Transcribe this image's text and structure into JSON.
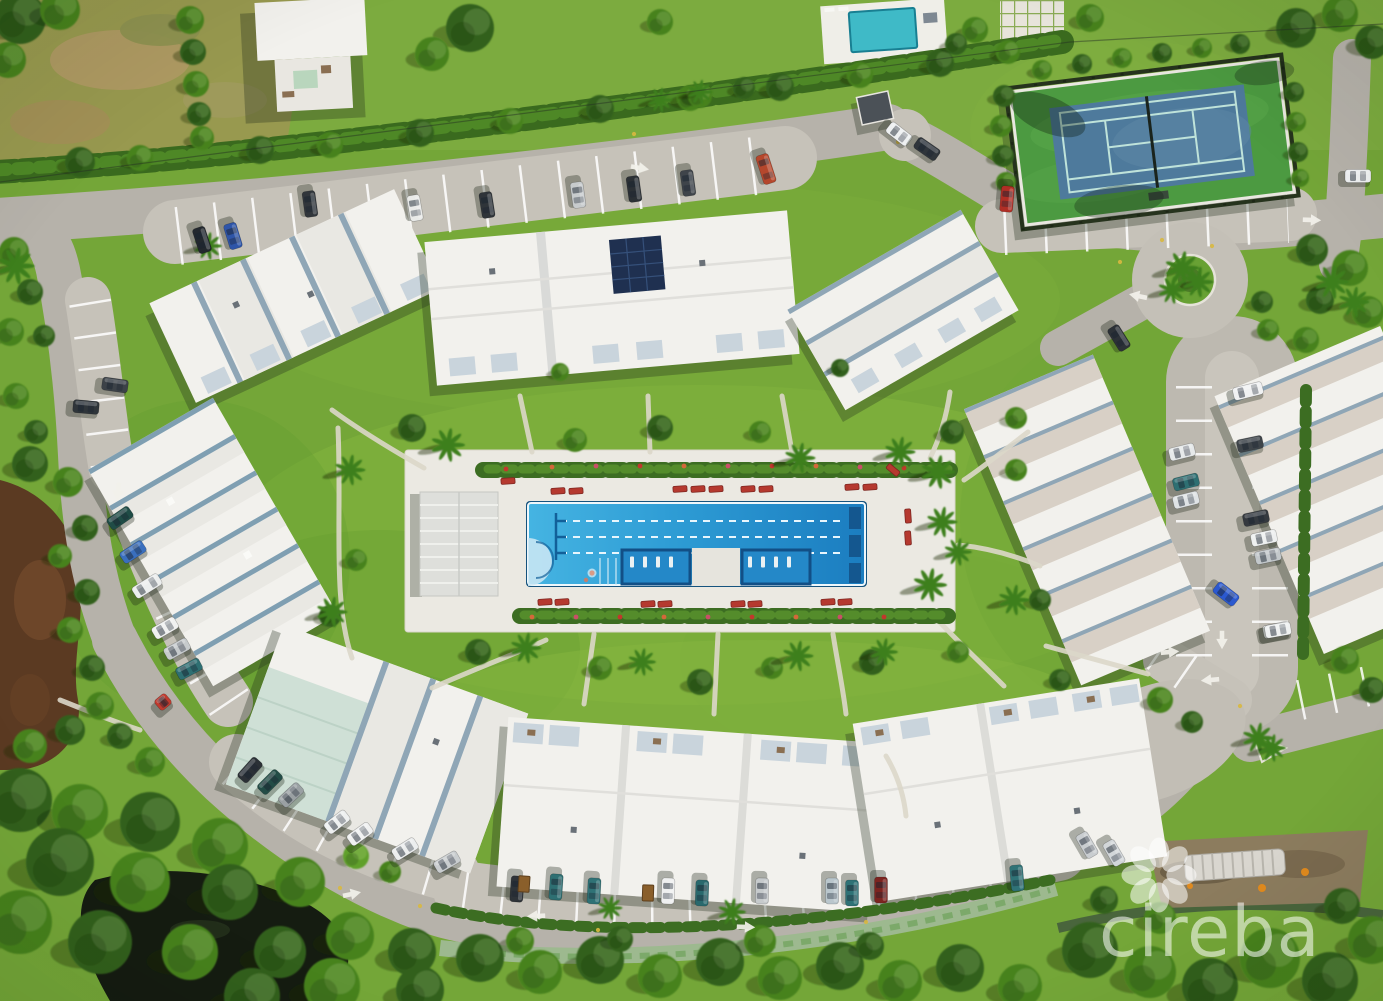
{
  "scene": {
    "description": "Aerial drone photo of a condominium community with central lap pool, tennis court, white-roof buildings, loop road, ponds and mangrove forest",
    "width": 1383,
    "height": 1001
  },
  "watermark": {
    "text": "cireba",
    "logo": "flower-petals-icon",
    "color": "rgba(255,255,255,0.55)"
  },
  "colors": {
    "grass": "#74a638",
    "road": "#b6b2aa",
    "road_light": "#c6c2b9",
    "pool_deck": "#ebe9e2",
    "pool_blue_light": "#3fb2e2",
    "pool_blue_deep": "#1b7dc0",
    "tennis_green": "#4c9a41",
    "tennis_blue": "#4e7a9c",
    "pond_brown": "#5b3a22",
    "pond_dark": "#151c11",
    "roof_white": "#f2f1ed",
    "solar_panel": "#1f3050"
  },
  "pool": {
    "lane_lines": 3,
    "shelves": 2,
    "pool_house": true
  },
  "scene_items": {
    "trees": [
      [
        20,
        18,
        26,
        "d"
      ],
      [
        60,
        10,
        20,
        "m"
      ],
      [
        8,
        60,
        18,
        "m"
      ],
      [
        190,
        20,
        14,
        "m"
      ],
      [
        193,
        52,
        13,
        "d"
      ],
      [
        196,
        84,
        13,
        "m"
      ],
      [
        199,
        114,
        12,
        "d"
      ],
      [
        202,
        138,
        12,
        "m"
      ],
      [
        80,
        162,
        15,
        "d"
      ],
      [
        140,
        158,
        13,
        "m"
      ],
      [
        260,
        150,
        14,
        "d"
      ],
      [
        330,
        145,
        13,
        "m"
      ],
      [
        420,
        133,
        14,
        "d"
      ],
      [
        510,
        121,
        13,
        "m"
      ],
      [
        600,
        109,
        14,
        "d"
      ],
      [
        690,
        98,
        13,
        "m"
      ],
      [
        780,
        87,
        14,
        "d"
      ],
      [
        860,
        75,
        13,
        "m"
      ],
      [
        940,
        63,
        14,
        "d"
      ],
      [
        1008,
        52,
        12,
        "m"
      ],
      [
        470,
        28,
        24,
        "d"
      ],
      [
        432,
        54,
        17,
        "m"
      ],
      [
        700,
        96,
        12,
        "m"
      ],
      [
        744,
        88,
        11,
        "d"
      ],
      [
        660,
        22,
        13,
        "m"
      ],
      [
        975,
        30,
        13,
        "m"
      ],
      [
        956,
        44,
        11,
        "d"
      ],
      [
        1090,
        18,
        14,
        "m"
      ],
      [
        1296,
        28,
        20,
        "d"
      ],
      [
        1340,
        14,
        18,
        "m"
      ],
      [
        1372,
        42,
        17,
        "d"
      ],
      [
        1004,
        96,
        11,
        "d"
      ],
      [
        1001,
        126,
        11,
        "m"
      ],
      [
        1003,
        156,
        11,
        "d"
      ],
      [
        1006,
        182,
        10,
        "m"
      ],
      [
        1294,
        92,
        10,
        "d"
      ],
      [
        1296,
        122,
        10,
        "m"
      ],
      [
        1298,
        152,
        10,
        "d"
      ],
      [
        1300,
        178,
        9,
        "m"
      ],
      [
        1042,
        70,
        10,
        "m"
      ],
      [
        1082,
        64,
        10,
        "d"
      ],
      [
        1122,
        58,
        10,
        "m"
      ],
      [
        1162,
        53,
        10,
        "d"
      ],
      [
        1202,
        48,
        10,
        "m"
      ],
      [
        1240,
        44,
        10,
        "d"
      ],
      [
        1312,
        250,
        16,
        "d"
      ],
      [
        1350,
        268,
        18,
        "m"
      ],
      [
        1320,
        300,
        14,
        "d"
      ],
      [
        1368,
        312,
        16,
        "m"
      ],
      [
        1306,
        340,
        13,
        "m"
      ],
      [
        1262,
        302,
        11,
        "d"
      ],
      [
        1268,
        330,
        11,
        "m"
      ],
      [
        14,
        252,
        15,
        "m"
      ],
      [
        30,
        292,
        13,
        "d"
      ],
      [
        10,
        332,
        14,
        "m"
      ],
      [
        44,
        336,
        11,
        "d"
      ],
      [
        16,
        396,
        13,
        "m"
      ],
      [
        36,
        432,
        12,
        "d"
      ],
      [
        30,
        464,
        18,
        "d"
      ],
      [
        68,
        482,
        15,
        "m"
      ],
      [
        85,
        528,
        13,
        "d"
      ],
      [
        60,
        556,
        12,
        "m"
      ],
      [
        87,
        592,
        13,
        "d"
      ],
      [
        70,
        630,
        13,
        "m"
      ],
      [
        92,
        668,
        13,
        "d"
      ],
      [
        100,
        706,
        14,
        "m"
      ],
      [
        70,
        730,
        15,
        "d"
      ],
      [
        30,
        746,
        17,
        "m"
      ],
      [
        120,
        736,
        13,
        "d"
      ],
      [
        150,
        762,
        15,
        "m"
      ],
      [
        20,
        800,
        32,
        "d"
      ],
      [
        80,
        812,
        28,
        "m"
      ],
      [
        150,
        822,
        30,
        "d"
      ],
      [
        220,
        846,
        28,
        "m"
      ],
      [
        60,
        862,
        34,
        "d"
      ],
      [
        140,
        882,
        30,
        "m"
      ],
      [
        230,
        892,
        28,
        "d"
      ],
      [
        300,
        882,
        25,
        "m"
      ],
      [
        20,
        922,
        32,
        "m"
      ],
      [
        100,
        942,
        32,
        "d"
      ],
      [
        190,
        952,
        28,
        "m"
      ],
      [
        280,
        952,
        26,
        "d"
      ],
      [
        350,
        936,
        24,
        "m"
      ],
      [
        412,
        952,
        24,
        "d"
      ],
      [
        332,
        986,
        28,
        "m"
      ],
      [
        420,
        990,
        24,
        "d"
      ],
      [
        252,
        996,
        28,
        "d"
      ],
      [
        356,
        856,
        13,
        "l"
      ],
      [
        390,
        872,
        11,
        "m"
      ],
      [
        480,
        958,
        24,
        "d"
      ],
      [
        540,
        972,
        22,
        "m"
      ],
      [
        600,
        960,
        24,
        "d"
      ],
      [
        660,
        976,
        22,
        "m"
      ],
      [
        720,
        962,
        24,
        "d"
      ],
      [
        780,
        978,
        22,
        "m"
      ],
      [
        840,
        966,
        24,
        "d"
      ],
      [
        900,
        982,
        22,
        "m"
      ],
      [
        960,
        968,
        24,
        "d"
      ],
      [
        1020,
        986,
        22,
        "m"
      ],
      [
        760,
        941,
        16,
        "m"
      ],
      [
        870,
        946,
        14,
        "d"
      ],
      [
        520,
        941,
        14,
        "m"
      ],
      [
        620,
        939,
        13,
        "d"
      ],
      [
        1090,
        950,
        28,
        "d"
      ],
      [
        1150,
        972,
        26,
        "m"
      ],
      [
        1210,
        986,
        28,
        "d"
      ],
      [
        1270,
        958,
        30,
        "m"
      ],
      [
        1330,
        980,
        28,
        "d"
      ],
      [
        1372,
        940,
        24,
        "m"
      ],
      [
        1342,
        906,
        18,
        "d"
      ],
      [
        1160,
        918,
        16,
        "m"
      ],
      [
        1104,
        900,
        14,
        "d"
      ],
      [
        1160,
        700,
        13,
        "m"
      ],
      [
        1192,
        722,
        11,
        "d"
      ],
      [
        412,
        428,
        14,
        "d"
      ],
      [
        575,
        440,
        12,
        "m"
      ],
      [
        660,
        428,
        13,
        "d"
      ],
      [
        760,
        432,
        11,
        "m"
      ],
      [
        952,
        432,
        12,
        "d"
      ],
      [
        356,
        560,
        11,
        "m"
      ],
      [
        478,
        652,
        13,
        "d"
      ],
      [
        600,
        668,
        12,
        "m"
      ],
      [
        700,
        682,
        13,
        "d"
      ],
      [
        772,
        668,
        11,
        "m"
      ],
      [
        872,
        662,
        13,
        "d"
      ],
      [
        958,
        652,
        11,
        "m"
      ],
      [
        1016,
        470,
        11,
        "m"
      ],
      [
        1040,
        600,
        11,
        "d"
      ],
      [
        330,
        616,
        11,
        "d"
      ],
      [
        560,
        372,
        9,
        "m"
      ],
      [
        840,
        368,
        9,
        "d"
      ],
      [
        1016,
        418,
        11,
        "m"
      ],
      [
        1060,
        680,
        11,
        "d"
      ],
      [
        1345,
        660,
        14,
        "m"
      ],
      [
        1372,
        690,
        13,
        "d"
      ]
    ],
    "palms": [
      [
        448,
        445,
        1.1
      ],
      [
        800,
        458,
        1.0
      ],
      [
        900,
        452,
        1.0
      ],
      [
        938,
        472,
        1.1
      ],
      [
        942,
        522,
        1.0
      ],
      [
        930,
        585,
        1.1
      ],
      [
        958,
        552,
        0.9
      ],
      [
        350,
        470,
        1.0
      ],
      [
        332,
        612,
        1.0
      ],
      [
        1014,
        600,
        1.0
      ],
      [
        1182,
        268,
        1.1
      ],
      [
        1198,
        282,
        1.0
      ],
      [
        1172,
        290,
        0.9
      ],
      [
        16,
        266,
        1.2
      ],
      [
        1332,
        282,
        1.1
      ],
      [
        1354,
        302,
        1.0
      ],
      [
        526,
        648,
        1.0
      ],
      [
        642,
        662,
        0.9
      ],
      [
        798,
        656,
        1.0
      ],
      [
        884,
        652,
        0.9
      ],
      [
        208,
        246,
        0.9
      ],
      [
        660,
        100,
        0.8
      ],
      [
        700,
        92,
        0.8
      ],
      [
        1258,
        738,
        1.0
      ],
      [
        1272,
        748,
        0.9
      ],
      [
        732,
        912,
        0.9
      ],
      [
        610,
        908,
        0.8
      ]
    ],
    "walkways": [
      "M 332,410 C 362,432 396,452 424,468",
      "M 520,396 L 532,452",
      "M 648,396 L 650,452",
      "M 782,396 L 792,452",
      "M 950,392 C 946,420 938,442 930,458",
      "M 338,428 C 342,520 332,600 352,658",
      "M 432,688 C 482,666 520,652 546,640",
      "M 584,704 L 594,634",
      "M 714,714 L 718,634",
      "M 846,714 C 843,688 837,660 833,634",
      "M 1004,686 C 976,658 952,636 936,618",
      "M 1028,432 C 1002,452 982,468 964,480",
      "M 886,756 C 898,776 904,796 906,816",
      "M 958,545 C 990,548 1016,556 1040,566",
      "M 60,700 C 90,712 115,722 140,730",
      "M 1046,646 C 1090,658 1120,666 1148,674"
    ],
    "loungers": [
      [
        558,
        491,
        -4
      ],
      [
        576,
        491,
        -4
      ],
      [
        680,
        489,
        -4
      ],
      [
        698,
        489,
        -4
      ],
      [
        716,
        489,
        -4
      ],
      [
        748,
        489,
        -4
      ],
      [
        766,
        489,
        -4
      ],
      [
        852,
        487,
        -4
      ],
      [
        870,
        487,
        -4
      ],
      [
        908,
        516,
        86
      ],
      [
        908,
        538,
        86
      ],
      [
        545,
        602,
        -4
      ],
      [
        562,
        602,
        -4
      ],
      [
        648,
        604,
        -4
      ],
      [
        665,
        604,
        -4
      ],
      [
        738,
        604,
        -4
      ],
      [
        755,
        604,
        -4
      ],
      [
        828,
        602,
        -4
      ],
      [
        845,
        602,
        -4
      ],
      [
        508,
        481,
        -4
      ],
      [
        893,
        470,
        40
      ]
    ],
    "pool_loungers": [
      [
        632,
        562
      ],
      [
        645,
        562
      ],
      [
        658,
        562
      ],
      [
        671,
        562
      ],
      [
        750,
        562
      ],
      [
        763,
        562
      ],
      [
        776,
        562
      ],
      [
        789,
        562
      ]
    ],
    "flowers": [
      [
        506,
        469
      ],
      [
        552,
        467
      ],
      [
        596,
        466
      ],
      [
        640,
        466
      ],
      [
        684,
        466
      ],
      [
        728,
        466
      ],
      [
        772,
        466
      ],
      [
        816,
        466
      ],
      [
        860,
        467
      ],
      [
        904,
        468
      ],
      [
        532,
        617
      ],
      [
        576,
        617
      ],
      [
        620,
        617
      ],
      [
        664,
        617
      ],
      [
        708,
        617
      ],
      [
        752,
        617
      ],
      [
        796,
        617
      ],
      [
        840,
        617
      ],
      [
        884,
        617
      ]
    ],
    "cars": [
      [
        202,
        240,
        72,
        "#23282e"
      ],
      [
        233,
        236,
        73,
        "#2e55a8"
      ],
      [
        310,
        204,
        82,
        "#31363b"
      ],
      [
        415,
        208,
        80,
        "#e9eae8"
      ],
      [
        487,
        205,
        81,
        "#2f3439"
      ],
      [
        578,
        195,
        82,
        "#c7cbcd"
      ],
      [
        634,
        189,
        82,
        "#2b3035"
      ],
      [
        688,
        183,
        82,
        "#3f444a"
      ],
      [
        766,
        169,
        72,
        "#b5472c",
        30
      ],
      [
        899,
        134,
        38,
        "#eef0f1"
      ],
      [
        927,
        149,
        35,
        "#2f353b"
      ],
      [
        1007,
        199,
        95,
        "#b02e25"
      ],
      [
        1358,
        176,
        0,
        "#eef0f1"
      ],
      [
        1119,
        338,
        58,
        "#2c3137"
      ],
      [
        1248,
        391,
        -14,
        "#f0f1f2",
        30
      ],
      [
        1182,
        452,
        -14,
        "#e6e9ea"
      ],
      [
        1186,
        482,
        -14,
        "#2e6f72"
      ],
      [
        1186,
        500,
        -14,
        "#dfe3e5"
      ],
      [
        1250,
        444,
        -12,
        "#3e4449"
      ],
      [
        1256,
        518,
        -12,
        "#34393f"
      ],
      [
        1264,
        538,
        -12,
        "#eef0f0"
      ],
      [
        1268,
        556,
        -12,
        "#c3c8cb"
      ],
      [
        1276,
        630,
        -12,
        "#e9ebec"
      ],
      [
        1226,
        594,
        38,
        "#2b59cf"
      ],
      [
        1278,
        630,
        -10,
        "#eff1f1"
      ],
      [
        86,
        407,
        5,
        "#2f353a"
      ],
      [
        115,
        385,
        8,
        "#3c4248"
      ],
      [
        120,
        518,
        -35,
        "#1f4c46"
      ],
      [
        133,
        552,
        -33,
        "#3a6fbe"
      ],
      [
        147,
        586,
        -32,
        "#eceeee",
        30
      ],
      [
        165,
        628,
        -30,
        "#f0f1f0"
      ],
      [
        177,
        649,
        -29,
        "#c6cacc"
      ],
      [
        189,
        669,
        -28,
        "#2e6f72"
      ],
      [
        163,
        702,
        -40,
        "#c03a2e",
        14
      ],
      [
        250,
        770,
        -48,
        "#2b3036"
      ],
      [
        270,
        782,
        -45,
        "#224c46"
      ],
      [
        291,
        795,
        -43,
        "#9aa0a3"
      ],
      [
        337,
        822,
        -38,
        "#eef0f0"
      ],
      [
        360,
        834,
        -36,
        "#f0f1f1"
      ],
      [
        405,
        849,
        -32,
        "#eceeee"
      ],
      [
        447,
        862,
        -30,
        "#c9cdcf"
      ],
      [
        517,
        889,
        94,
        "#2e3338"
      ],
      [
        556,
        887,
        94,
        "#2e6f72"
      ],
      [
        594,
        891,
        93,
        "#2f7276"
      ],
      [
        668,
        891,
        92,
        "#eff0f0"
      ],
      [
        702,
        893,
        92,
        "#29696d"
      ],
      [
        762,
        891,
        91,
        "#c6cacc"
      ],
      [
        832,
        891,
        90,
        "#b9c6cc"
      ],
      [
        852,
        893,
        90,
        "#2f7276"
      ],
      [
        881,
        890,
        90,
        "#7c2420"
      ],
      [
        1017,
        878,
        85,
        "#2f7276"
      ],
      [
        1087,
        845,
        60,
        "#c9cdd0"
      ],
      [
        1114,
        853,
        60,
        "#d2d6d9"
      ]
    ],
    "bins": [
      [
        648,
        893,
        92
      ],
      [
        524,
        884,
        94
      ]
    ],
    "arrows": [
      [
        640,
        168,
        100
      ],
      [
        118,
        492,
        185
      ],
      [
        352,
        894,
        78
      ],
      [
        746,
        927,
        92
      ],
      [
        1222,
        640,
        180
      ],
      [
        1138,
        296,
        -78
      ],
      [
        536,
        916,
        268
      ],
      [
        1312,
        220,
        92
      ],
      [
        1210,
        680,
        -95
      ],
      [
        1170,
        652,
        85
      ]
    ],
    "dots": [
      [
        898,
        142
      ],
      [
        1162,
        240
      ],
      [
        1212,
        246
      ],
      [
        340,
        888
      ],
      [
        420,
        906
      ],
      [
        1240,
        706
      ],
      [
        1120,
        262
      ],
      [
        634,
        134
      ],
      [
        598,
        930
      ],
      [
        866,
        922
      ]
    ]
  }
}
